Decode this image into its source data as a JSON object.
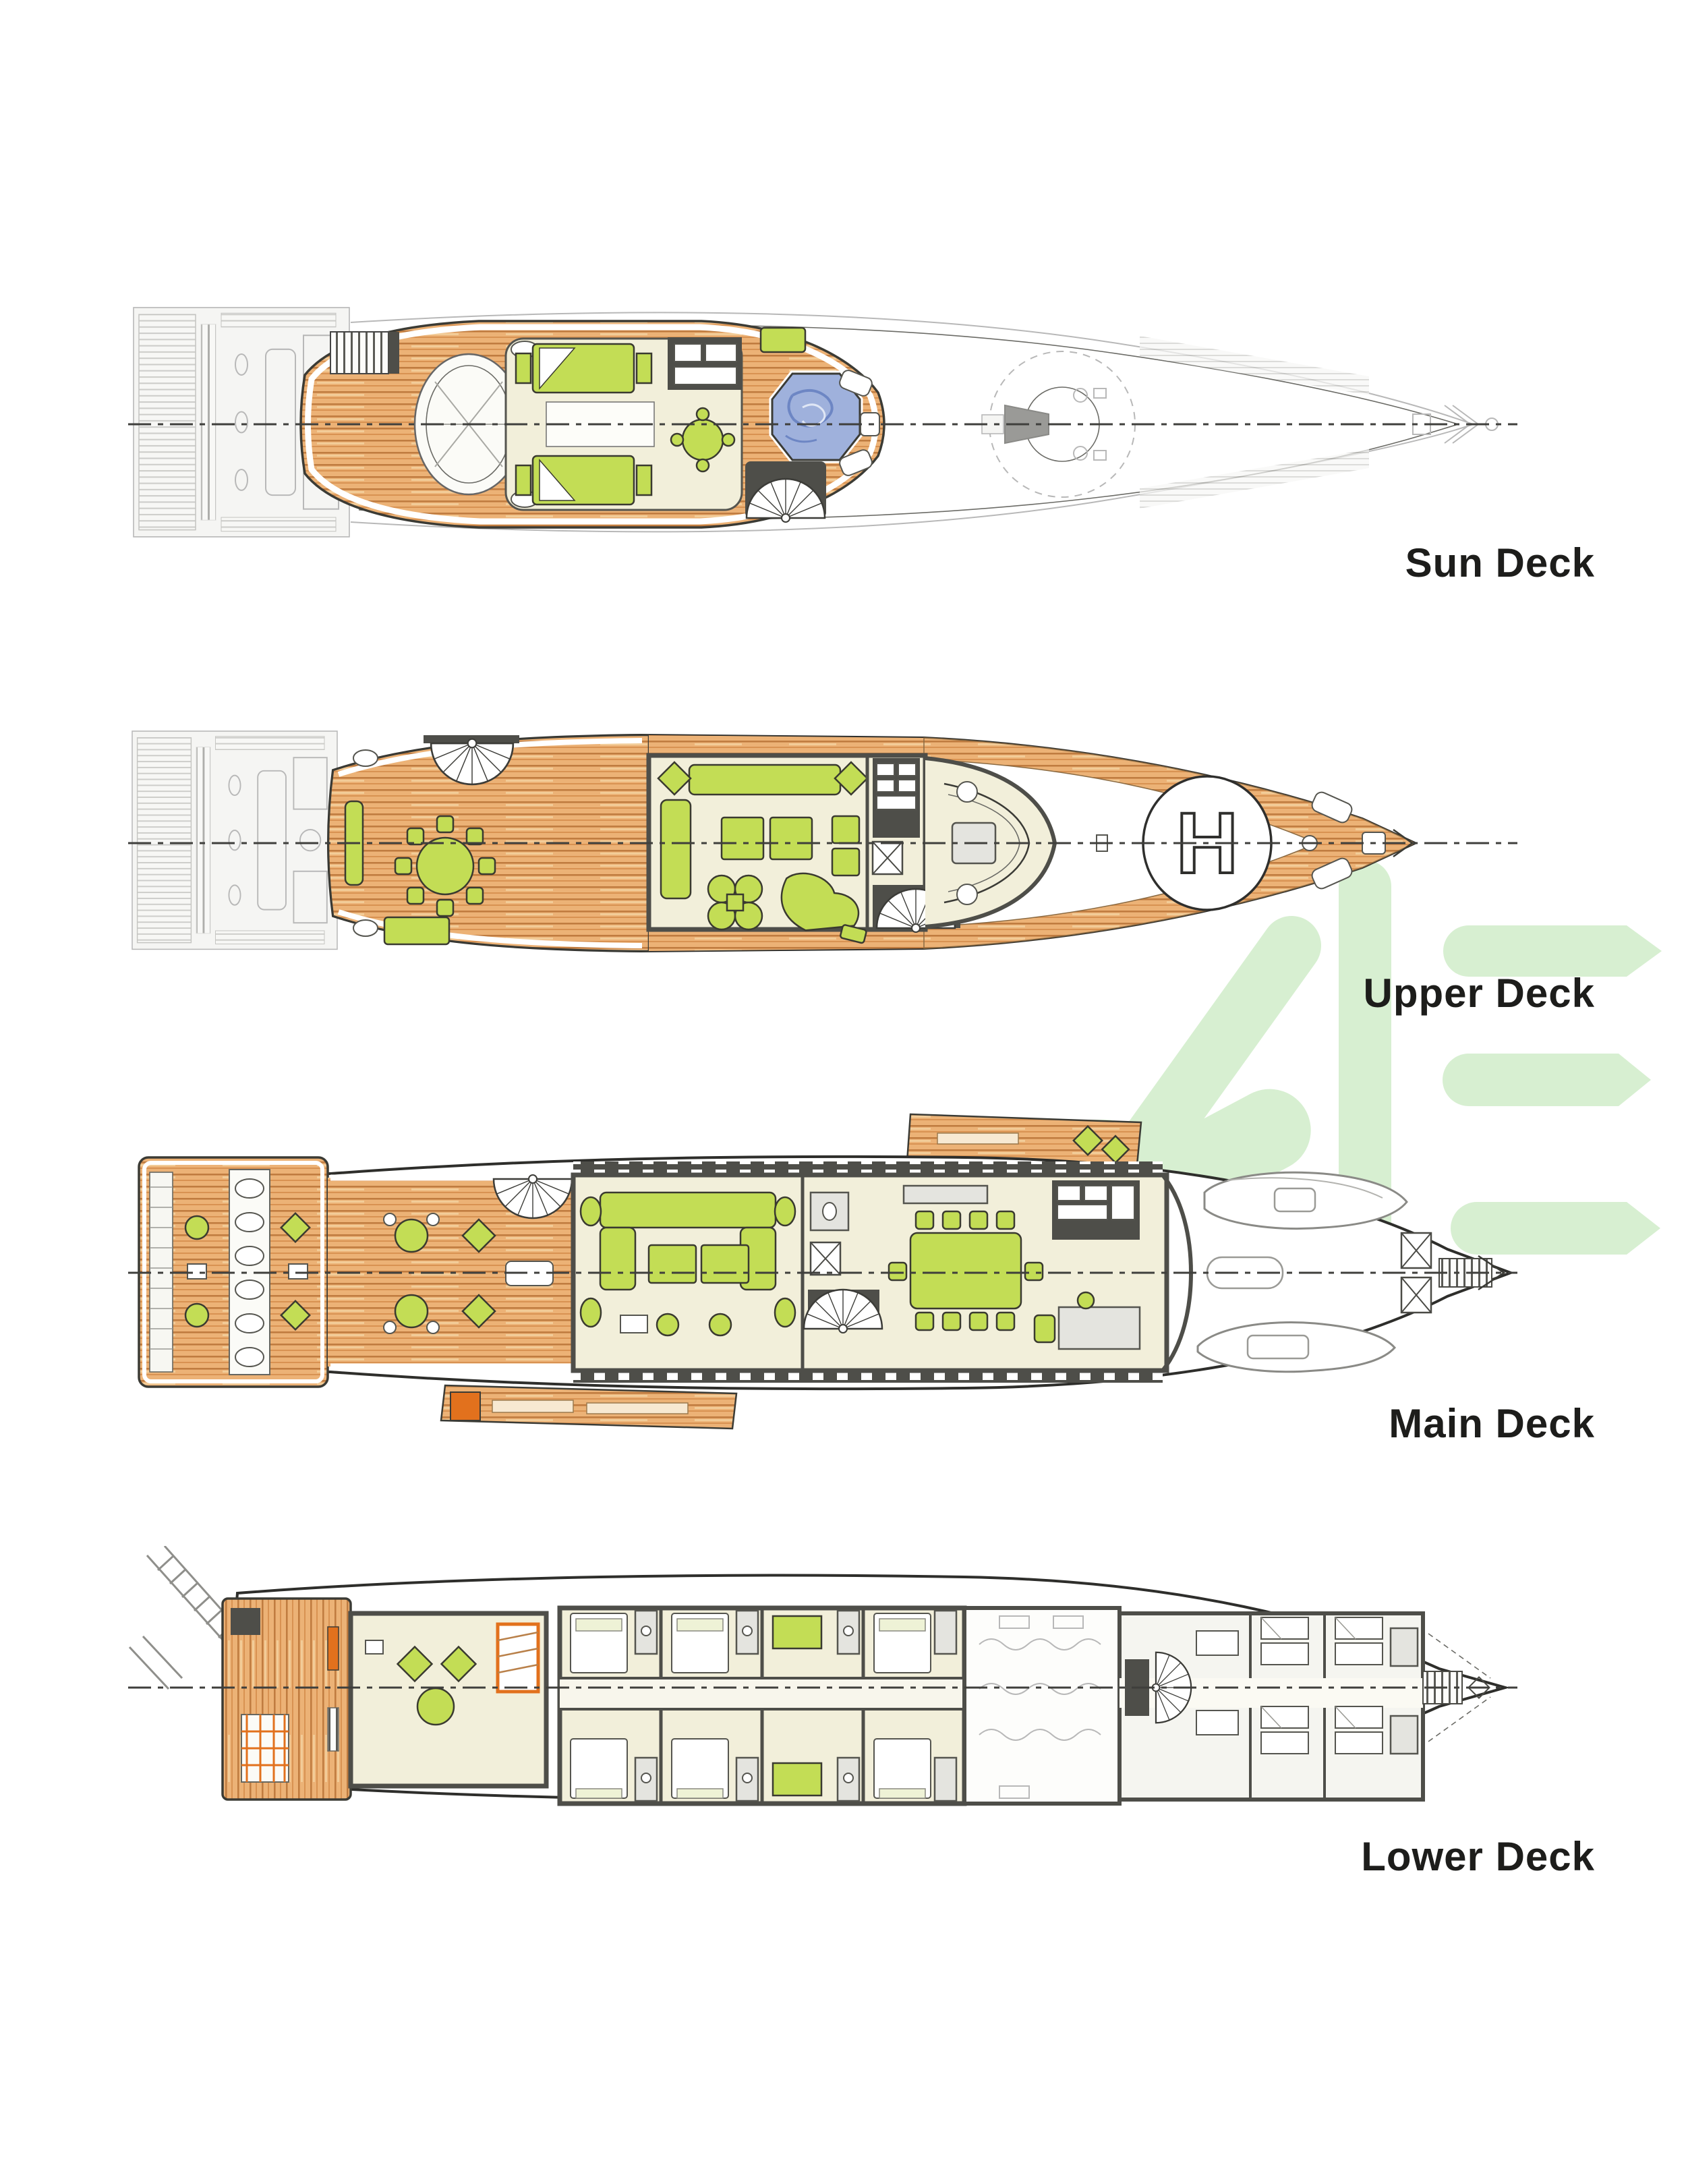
{
  "document": {
    "type": "yacht-deck-plans",
    "background": "#ffffff"
  },
  "decks": [
    {
      "id": "sun-deck",
      "label": "Sun Deck"
    },
    {
      "id": "upper-deck",
      "label": "Upper Deck",
      "helipad_marking": "H"
    },
    {
      "id": "main-deck",
      "label": "Main Deck"
    },
    {
      "id": "lower-deck",
      "label": "Lower Deck"
    }
  ],
  "watermark": {
    "letters": "ME",
    "color": "#d7efd1"
  },
  "colors": {
    "page_bg": "#ffffff",
    "label_text": "#1d1d1b",
    "watermark_green": "#d7efd1",
    "teak_wood": "#ecb276",
    "teak_stripe": "#c07c40",
    "teak_mid": "#d89252",
    "teak_light": "#f4d09e",
    "interior_floor": "#f2efda",
    "furniture_green": "#c3dd55",
    "wall_gray": "#4e4e49",
    "ghost_gray": "#b8b8b8",
    "jacuzzi_blue": "#9fb1dc",
    "accent_orange": "#e2711d"
  }
}
